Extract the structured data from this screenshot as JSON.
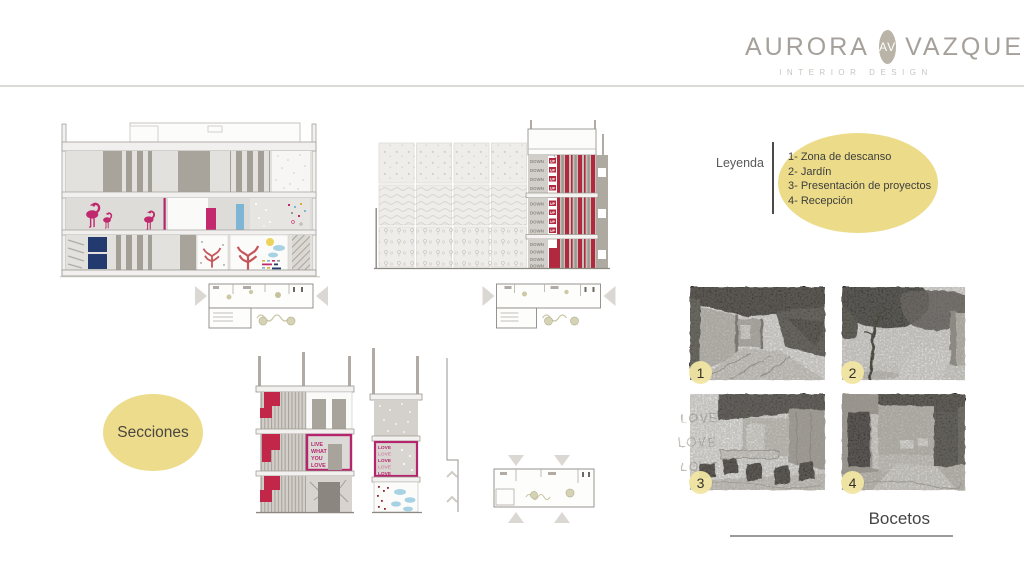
{
  "brand": {
    "first": "AURORA",
    "monogram": "AV",
    "last": "VAZQUEZ",
    "tagline": "INTERIOR DESIGN"
  },
  "legend": {
    "label": "Leyenda",
    "items": [
      "1- Zona de descanso",
      "2- Jardín",
      "3- Presentación de proyectos",
      "4- Recepción"
    ]
  },
  "labels": {
    "sections_bubble": "Secciones",
    "sketches_title": "Bocetos"
  },
  "drawings": {
    "down": "DOWN",
    "up": "UP",
    "quote_lines": [
      "LIVE",
      "WHAT",
      "YOU",
      "LOVE"
    ],
    "love": "LOVE"
  },
  "sketches": [
    {
      "number": "1"
    },
    {
      "number": "2"
    },
    {
      "number": "3"
    },
    {
      "number": "4"
    }
  ],
  "colors": {
    "accent_yellow": "#ecdc8a",
    "magenta": "#c0296d",
    "crimson": "#b2293f",
    "navy": "#223a6d",
    "sky_blue": "#7fb5d4",
    "tree_red": "#c4565c",
    "logo_gray": "#a5a09a"
  }
}
